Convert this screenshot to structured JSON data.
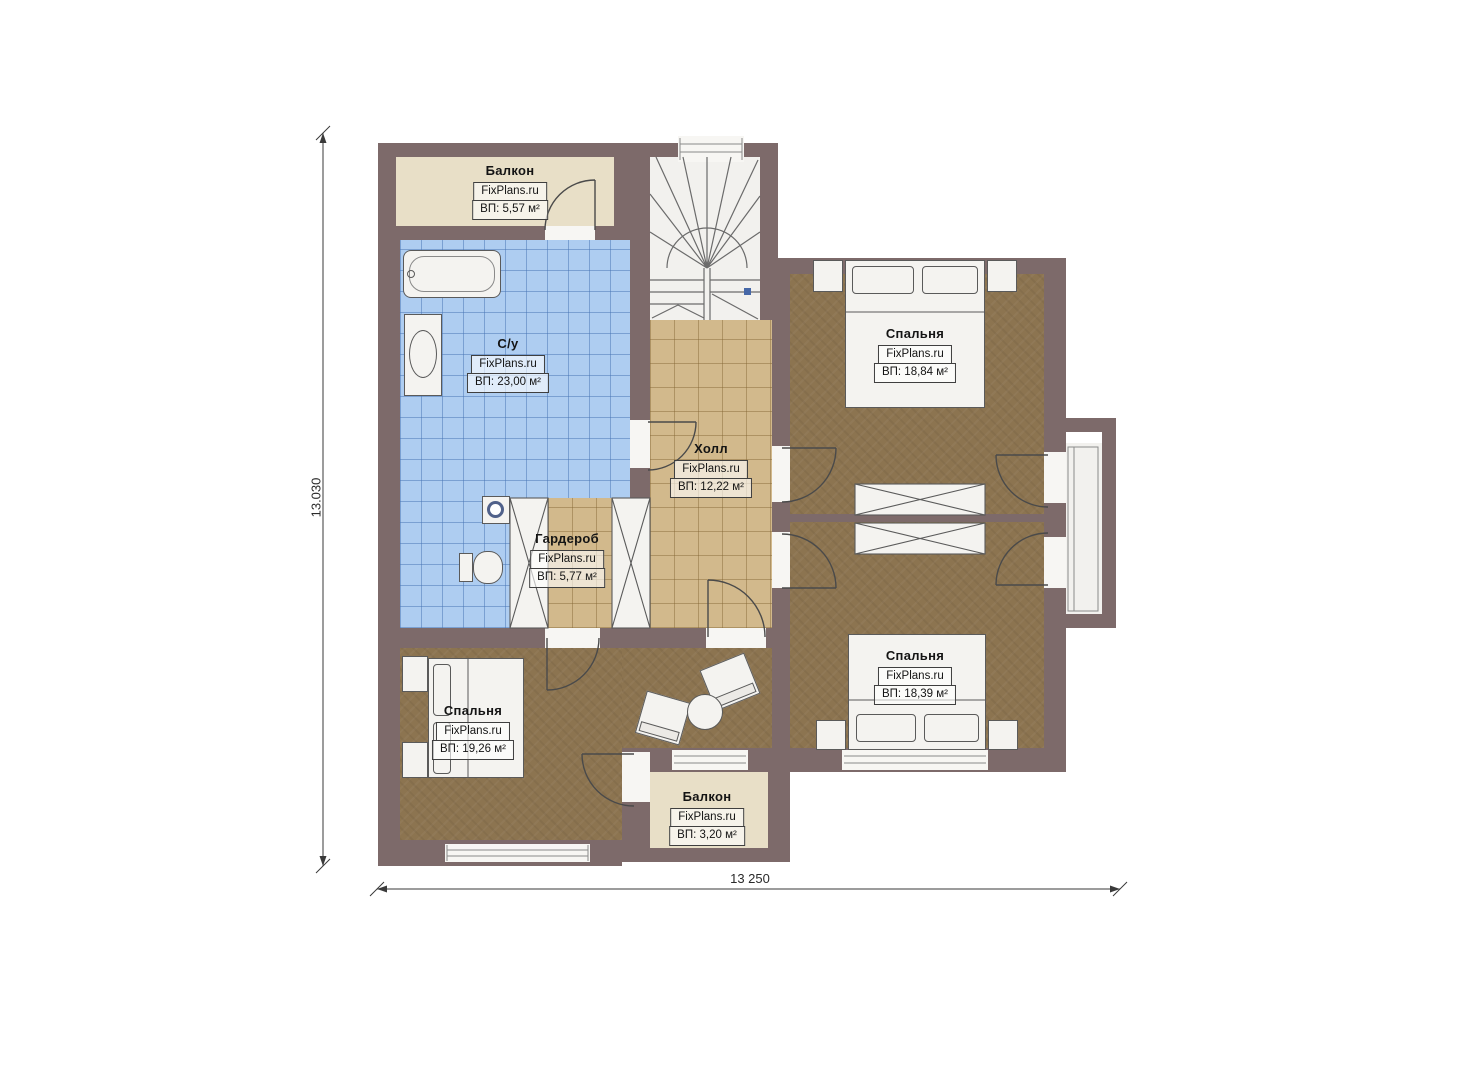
{
  "plan": {
    "watermark": "FixPlans.ru",
    "rooms": [
      {
        "id": "balcony-top",
        "name": "Балкон",
        "watermark": "FixPlans.ru",
        "area": "ВП: 5,57 м²"
      },
      {
        "id": "bathroom",
        "name": "С/у",
        "watermark": "FixPlans.ru",
        "area": "ВП: 23,00 м²"
      },
      {
        "id": "hall",
        "name": "Холл",
        "watermark": "FixPlans.ru",
        "area": "ВП: 12,22 м²"
      },
      {
        "id": "wardrobe",
        "name": "Гардероб",
        "watermark": "FixPlans.ru",
        "area": "ВП: 5,77 м²"
      },
      {
        "id": "bedroom-top-right",
        "name": "Спальня",
        "watermark": "FixPlans.ru",
        "area": "ВП: 18,84 м²"
      },
      {
        "id": "bedroom-bottom-right",
        "name": "Спальня",
        "watermark": "FixPlans.ru",
        "area": "ВП: 18,39 м²"
      },
      {
        "id": "bedroom-bottom-left",
        "name": "Спальня",
        "watermark": "FixPlans.ru",
        "area": "ВП: 19,26 м²"
      },
      {
        "id": "balcony-bottom",
        "name": "Балкон",
        "watermark": "FixPlans.ru",
        "area": "ВП: 3,20 м²"
      }
    ],
    "dimensions": {
      "height_label": "13.030",
      "width_label": "13 250"
    },
    "palette": {
      "wall": "#7d6a6a",
      "balcony_floor": "#e8dfc7",
      "bathroom_tile": "#aecdf1",
      "hall_tile": "#d2b98c",
      "bedroom_floor": "#8c7450",
      "stair_accent": "#4668a8"
    }
  }
}
